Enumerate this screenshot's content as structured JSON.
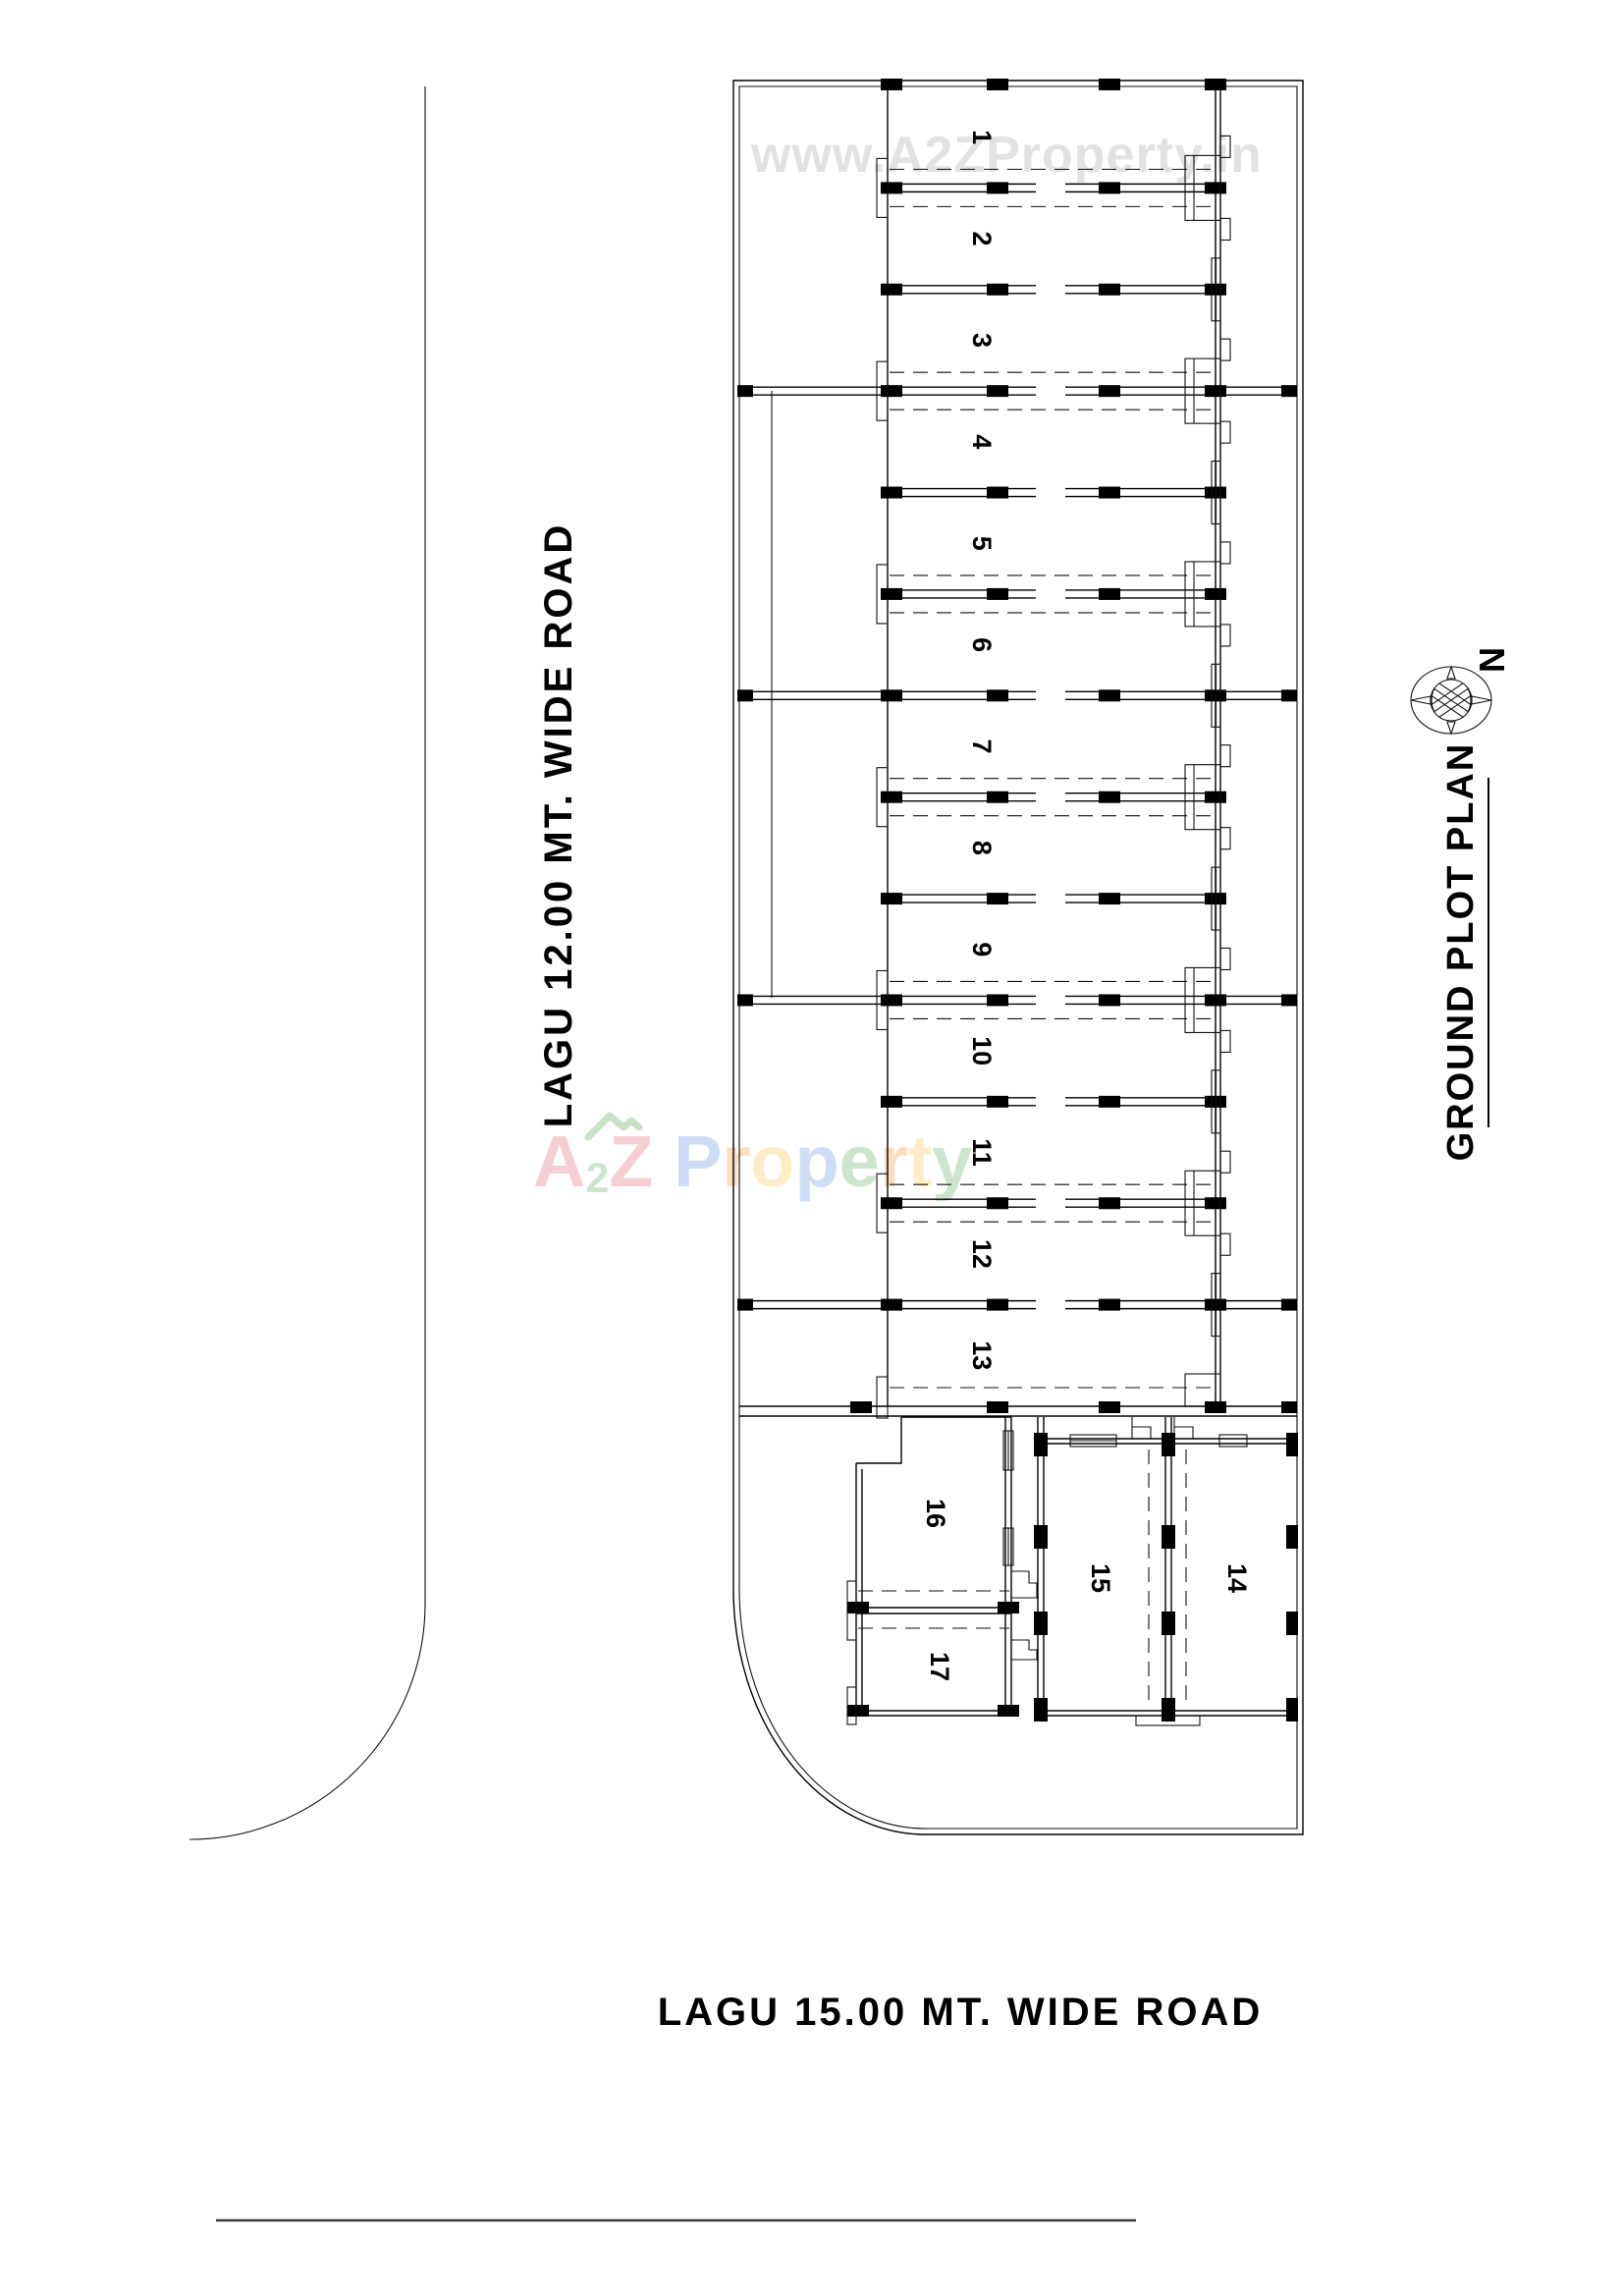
{
  "texts": {
    "road_left_label": "LAGU 12.00 MT. WIDE ROAD",
    "road_bottom_label": "LAGU 15.00 MT. WIDE ROAD",
    "drawing_title": "GROUND PLOT PLAN",
    "north_label": "N"
  },
  "watermarks": {
    "url_watermark": "www.A2ZProperty.in",
    "brand_letters": [
      {
        "ch": "A",
        "color": "#f0a8b2",
        "small": false
      },
      {
        "ch": "2",
        "color": "#a8cfa8",
        "small": true
      },
      {
        "ch": "Z",
        "color": "#f0a8b2",
        "small": false
      },
      {
        "ch": " ",
        "color": "#000000",
        "small": false
      },
      {
        "ch": "P",
        "color": "#a9c4ef",
        "small": false
      },
      {
        "ch": "r",
        "color": "#f6c08b",
        "small": false
      },
      {
        "ch": "o",
        "color": "#f8e09a",
        "small": false
      },
      {
        "ch": "p",
        "color": "#a9c4ef",
        "small": false
      },
      {
        "ch": "e",
        "color": "#a8cfa8",
        "small": false
      },
      {
        "ch": "r",
        "color": "#f6c08b",
        "small": false
      },
      {
        "ch": "t",
        "color": "#f8e09a",
        "small": false
      },
      {
        "ch": "y",
        "color": "#a8cfa8",
        "small": false
      }
    ],
    "brand_roof_color": "#9fc99f"
  },
  "plan": {
    "main_units": [
      "1",
      "2",
      "3",
      "4",
      "5",
      "6",
      "7",
      "8",
      "9",
      "10",
      "11",
      "12",
      "13"
    ],
    "lower_units": [
      "14",
      "15",
      "16",
      "17"
    ]
  },
  "colors": {
    "line": "#000000",
    "watermark_gray": "#e2e2e2",
    "footer_line": "#3c3c3c",
    "background": "#ffffff"
  }
}
